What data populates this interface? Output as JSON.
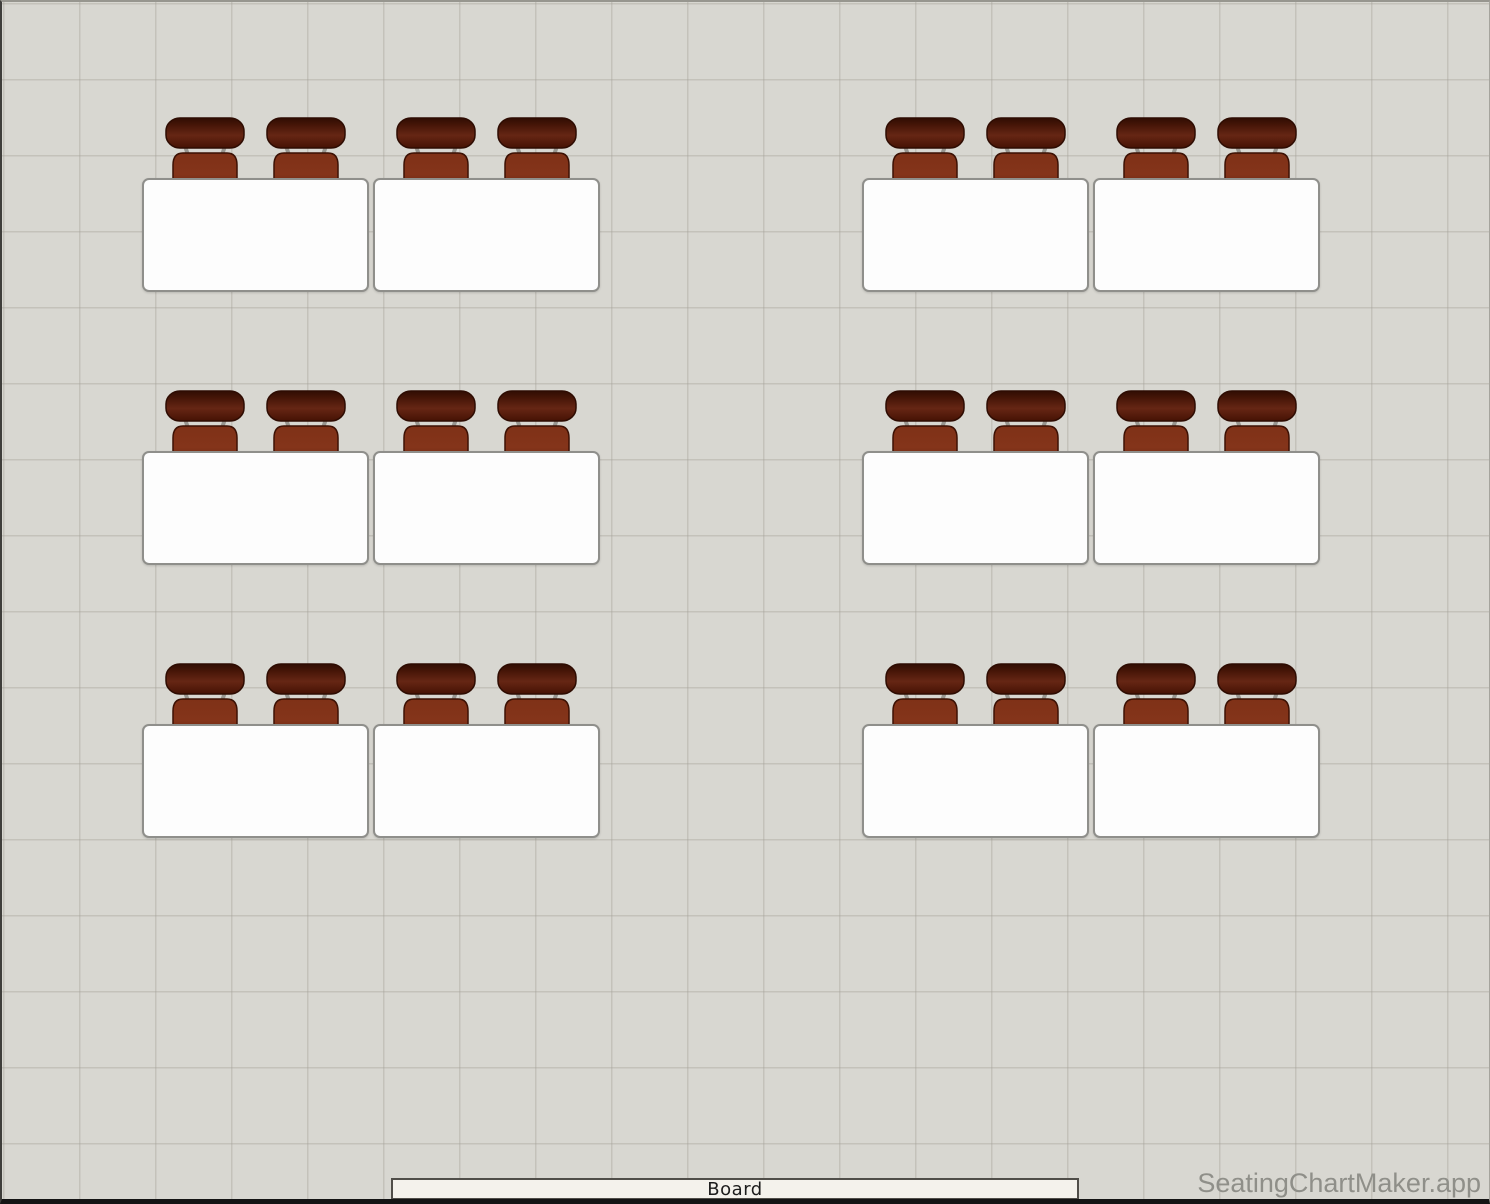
{
  "app": {
    "watermark": "SeatingChartMaker.app"
  },
  "board": {
    "label": "Board",
    "x": 389,
    "y": 1176,
    "width": 688,
    "height": 22
  },
  "canvas": {
    "width": 1490,
    "height": 1204,
    "background": "#d8d7d1",
    "grid_line": "#a4a299",
    "grid_size": 76
  },
  "colors": {
    "desk_fill": "#fdfdfd",
    "desk_border": "#8f8f8b",
    "chair_back_top": "#300d03",
    "chair_back_mid": "#5e2210",
    "chair_seat_light": "#84341a",
    "chair_seat_dark": "#531a0a",
    "chair_outline": "#2e0c02",
    "strut": "#97958f",
    "board_fill": "#f4f2ec",
    "board_border": "#504e49",
    "watermark_color": "#8f8f89"
  },
  "layout": {
    "desk_width": 227,
    "desk_height": 114,
    "chair_width": 82,
    "chair_height": 86,
    "chair_offset_y": -63,
    "chair_offsets_x": [
      22,
      123
    ],
    "desks": [
      {
        "x": 140,
        "y": 176
      },
      {
        "x": 371,
        "y": 176
      },
      {
        "x": 860,
        "y": 176
      },
      {
        "x": 1091,
        "y": 176
      },
      {
        "x": 140,
        "y": 449
      },
      {
        "x": 371,
        "y": 449
      },
      {
        "x": 860,
        "y": 449
      },
      {
        "x": 1091,
        "y": 449
      },
      {
        "x": 140,
        "y": 722
      },
      {
        "x": 371,
        "y": 722
      },
      {
        "x": 860,
        "y": 722
      },
      {
        "x": 1091,
        "y": 722
      }
    ]
  }
}
